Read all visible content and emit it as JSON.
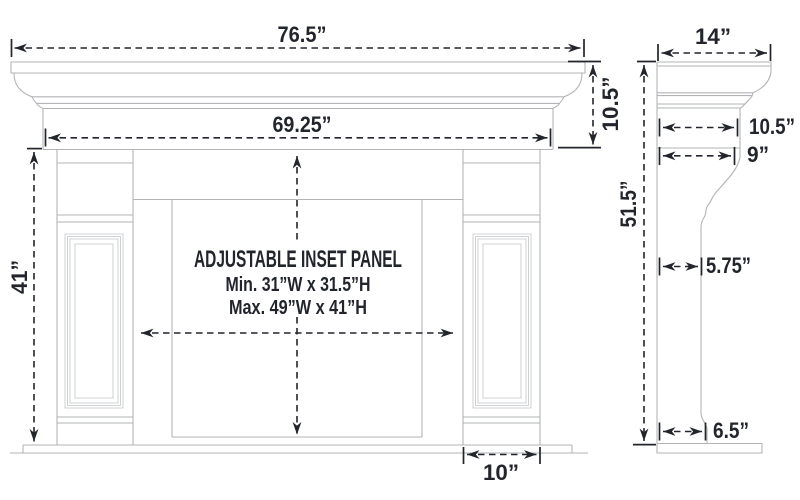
{
  "colors": {
    "dimension_text": "#22252c",
    "drawing_line": "#b2b4b6"
  },
  "front": {
    "overall_width": "76.5”",
    "header_width": "69.25”",
    "header_height": "10.5”",
    "leg_height": "41”",
    "leg_width": "10”",
    "inset_panel": {
      "title": "ADJUSTABLE INSET PANEL",
      "min": "Min. 31”W x 31.5”H",
      "max": "Max. 49”W x 41”H"
    }
  },
  "side": {
    "shelf_depth": "14”",
    "overall_height": "51.5”",
    "header_depth": "10.5”",
    "crown_base_depth": "9”",
    "leg_depth": "5.75”",
    "base_depth": "6.5”"
  }
}
